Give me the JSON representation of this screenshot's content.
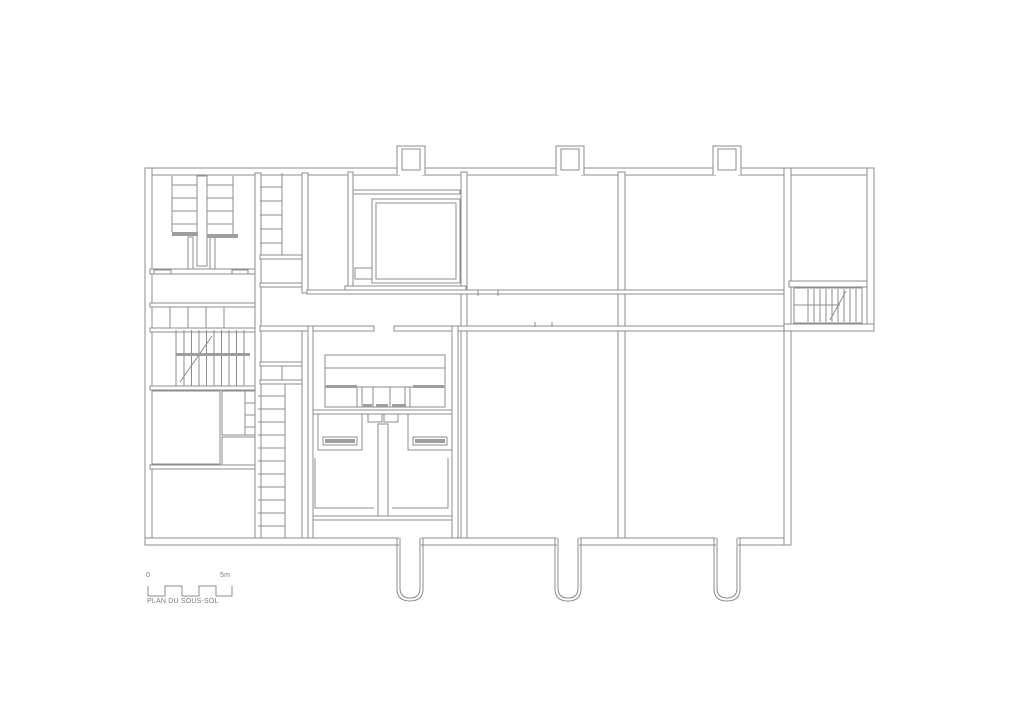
{
  "labels": {
    "title": "PLAN DU SOUS-SOL",
    "scale_start": "0",
    "scale_end": "5m"
  },
  "colors": {
    "line": "#8c8c8c",
    "thick": "#9e9e9e",
    "text": "#7a7a7a",
    "background": "#ffffff"
  },
  "canvas": {
    "width": 1024,
    "height": 724
  },
  "plan": {
    "walls": [
      [
        145,
        168,
        729,
        7
      ],
      [
        145,
        168,
        7,
        377
      ],
      [
        145,
        538,
        646,
        7
      ],
      [
        784,
        168,
        7,
        377
      ],
      [
        867,
        168,
        7,
        163
      ],
      [
        784,
        324,
        90,
        7
      ],
      [
        789,
        281,
        78,
        6
      ],
      [
        255,
        173,
        6,
        365
      ],
      [
        302,
        173,
        6,
        120
      ],
      [
        302,
        326,
        6,
        212
      ],
      [
        348,
        172,
        5,
        118
      ],
      [
        461,
        172,
        6,
        366
      ],
      [
        618,
        172,
        7,
        366
      ],
      [
        307,
        290,
        477,
        4
      ],
      [
        307,
        326,
        67,
        5
      ],
      [
        394,
        326,
        390,
        5
      ],
      [
        260,
        326,
        48,
        5
      ],
      [
        150,
        269,
        105,
        5
      ],
      [
        150,
        303,
        105,
        4
      ],
      [
        150,
        328,
        105,
        4
      ],
      [
        150,
        386,
        105,
        4
      ],
      [
        150,
        465,
        105,
        4
      ],
      [
        260,
        255,
        42,
        4
      ],
      [
        260,
        283,
        42,
        4
      ],
      [
        260,
        362,
        42,
        4
      ],
      [
        260,
        380,
        42,
        4
      ],
      [
        353,
        190,
        107,
        4
      ],
      [
        345,
        286,
        121,
        4
      ],
      [
        308,
        326,
        5,
        212
      ],
      [
        452,
        326,
        6,
        212
      ],
      [
        313,
        410,
        139,
        4
      ],
      [
        313,
        516,
        139,
        4
      ],
      [
        378,
        424,
        10,
        92
      ],
      [
        197,
        176,
        10,
        90
      ],
      [
        188,
        237,
        5,
        32
      ],
      [
        210,
        237,
        5,
        32
      ]
    ],
    "rooms": [
      [
        372,
        199,
        88,
        84
      ],
      [
        376,
        203,
        80,
        76
      ],
      [
        355,
        268,
        17,
        11
      ],
      [
        152,
        391,
        68,
        73
      ],
      [
        222,
        391,
        33,
        44
      ],
      [
        222,
        437,
        33,
        28
      ],
      [
        794,
        288,
        68,
        35
      ],
      [
        325,
        355,
        120,
        52
      ],
      [
        318,
        414,
        44,
        36
      ],
      [
        408,
        414,
        44,
        36
      ],
      [
        368,
        414,
        14,
        8
      ],
      [
        384,
        414,
        14,
        8
      ],
      [
        323,
        437,
        34,
        8
      ],
      [
        413,
        437,
        34,
        8
      ],
      [
        357,
        387,
        5,
        20
      ],
      [
        405,
        387,
        5,
        20
      ],
      [
        152,
        307,
        72,
        21
      ],
      [
        154,
        270,
        17,
        4
      ],
      [
        232,
        270,
        16,
        4
      ]
    ],
    "stairs": [
      {
        "dir": "h",
        "from": 172,
        "to": 197,
        "start": 185,
        "step": 13,
        "count": 4
      },
      {
        "dir": "h",
        "from": 207,
        "to": 233,
        "start": 185,
        "step": 13,
        "count": 4
      },
      {
        "dir": "h",
        "from": 260,
        "to": 282,
        "start": 187,
        "step": 14,
        "count": 5
      },
      {
        "dir": "v",
        "from": 330,
        "to": 386,
        "start": 184,
        "step": 7.5,
        "count": 9
      },
      {
        "dir": "h",
        "from": 258,
        "to": 285,
        "start": 396,
        "step": 13,
        "count": 11
      },
      {
        "dir": "v",
        "from": 289,
        "to": 322,
        "start": 808,
        "step": 6,
        "count": 9
      }
    ],
    "lines": [
      [
        172,
        176,
        172,
        232
      ],
      [
        233,
        176,
        233,
        234
      ],
      [
        282,
        173,
        282,
        255
      ],
      [
        282,
        366,
        282,
        380
      ],
      [
        285,
        384,
        285,
        538
      ],
      [
        176,
        330,
        176,
        386
      ],
      [
        180,
        382,
        212,
        336
      ],
      [
        830,
        320,
        846,
        291
      ],
      [
        794,
        305,
        840,
        305
      ],
      [
        325,
        368,
        445,
        368
      ],
      [
        325,
        387,
        445,
        387
      ],
      [
        373,
        387,
        373,
        407
      ],
      [
        390,
        387,
        390,
        407
      ],
      [
        245,
        391,
        245,
        435
      ],
      [
        245,
        403,
        255,
        403
      ],
      [
        245,
        415,
        255,
        415
      ],
      [
        245,
        427,
        255,
        427
      ],
      [
        374,
        326,
        374,
        331
      ],
      [
        394,
        326,
        394,
        331
      ],
      [
        478,
        290,
        478,
        296
      ],
      [
        498,
        290,
        498,
        296
      ],
      [
        535,
        322,
        535,
        327
      ],
      [
        552,
        322,
        552,
        327
      ],
      [
        170,
        307,
        170,
        328
      ],
      [
        188,
        307,
        188,
        328
      ],
      [
        206,
        307,
        206,
        328
      ]
    ],
    "polylines": [
      [
        [
          315,
          458
        ],
        [
          315,
          508
        ],
        [
          374,
          508
        ]
      ],
      [
        [
          448,
          458
        ],
        [
          448,
          508
        ],
        [
          392,
          508
        ]
      ]
    ],
    "thick_bars": [
      [
        172,
        232,
        26,
        4
      ],
      [
        207,
        234,
        31,
        4
      ],
      [
        176,
        353,
        74,
        3
      ],
      [
        326,
        385,
        31,
        3
      ],
      [
        413,
        385,
        31,
        3
      ],
      [
        363,
        404,
        9,
        3
      ],
      [
        376,
        404,
        12,
        3
      ],
      [
        392,
        404,
        14,
        3
      ],
      [
        325,
        439,
        30,
        4
      ],
      [
        415,
        439,
        30,
        4
      ]
    ],
    "chimneys": {
      "centers": [
        411,
        570,
        727
      ]
    },
    "wells": {
      "centers": [
        410,
        568,
        727
      ]
    },
    "scale_bar": {
      "points": [
        [
          148,
          586
        ],
        [
          148,
          596
        ],
        [
          165,
          596
        ],
        [
          165,
          586
        ],
        [
          182,
          586
        ],
        [
          182,
          596
        ],
        [
          199,
          596
        ],
        [
          199,
          586
        ],
        [
          216,
          586
        ],
        [
          216,
          596
        ],
        [
          232,
          596
        ],
        [
          232,
          586
        ]
      ]
    }
  }
}
